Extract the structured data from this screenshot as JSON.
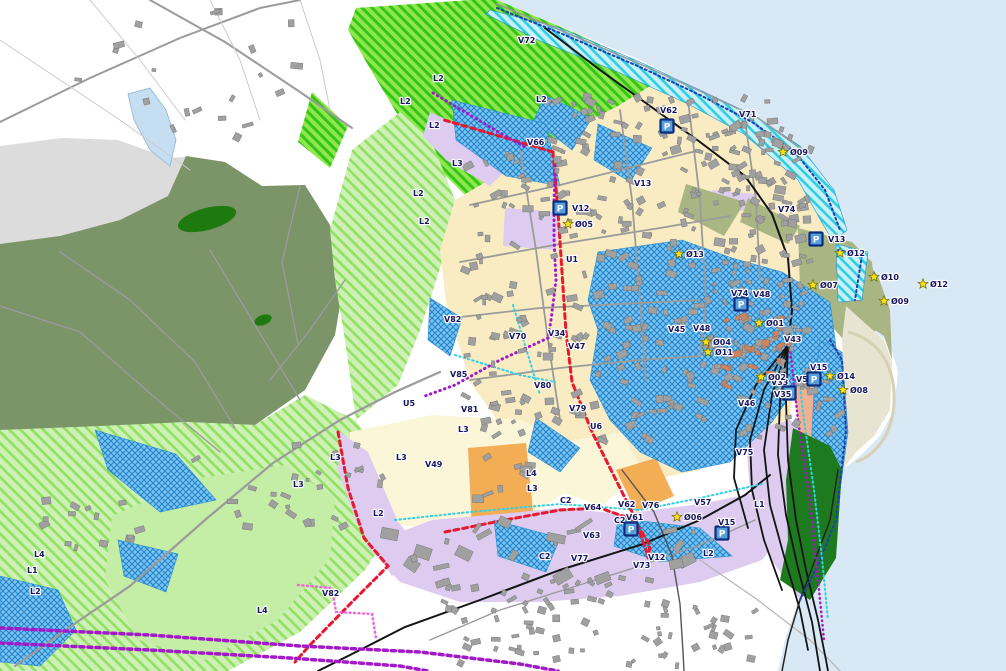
{
  "map": {
    "title": "municipal zoning map",
    "colors": {
      "sea": "#d9e8f5",
      "land": "#ffffff",
      "gray_zone": "#dcdcdc",
      "forest": "#7b9468",
      "forest_dark": "#1d7a0e",
      "lime_base": "#8fe750",
      "lime_stripe": "#35c517",
      "green_base": "#cdf0b4",
      "green_stripe": "#92e063",
      "green_plain": "#c4eda6",
      "beige": "#f9ecc3",
      "pale_yellow": "#fbf6d8",
      "orange": "#f2ad55",
      "lavender": "#ddccf0",
      "salmon": "#f0b193",
      "salmon_building": "#d4825c",
      "olive": "#a9b583",
      "pier_green": "#1d7a1f",
      "flood_base": "#7fc3ee",
      "flood_stripe": "#1f86cf",
      "cyan_base": "#c8f0f6",
      "cyan_stripe": "#2ecfe3",
      "building": "#a0a0a0",
      "road": "#9b9b9b",
      "rail": "#141414",
      "red_line": "#e8192e",
      "purple_line": "#a219c9",
      "pink_line": "#ee6ad8",
      "navy_line": "#1f3fb0",
      "cyan_line": "#35cfe2",
      "star_fill": "#ffe11a",
      "icon_fill": "#58a0dc",
      "icon_border": "#0b2d7d",
      "label_color": "#141460",
      "lake": "#c5def2",
      "sand": "#e8e4d2"
    },
    "labels": [
      {
        "t": "V72",
        "x": 518,
        "y": 43
      },
      {
        "t": "L2",
        "x": 433,
        "y": 81
      },
      {
        "t": "L2",
        "x": 536,
        "y": 102
      },
      {
        "t": "L2",
        "x": 400,
        "y": 104
      },
      {
        "t": "V71",
        "x": 739,
        "y": 117
      },
      {
        "t": "L2",
        "x": 429,
        "y": 128
      },
      {
        "t": "V66",
        "x": 527,
        "y": 145
      },
      {
        "t": "L3",
        "x": 452,
        "y": 166
      },
      {
        "t": "V13",
        "x": 634,
        "y": 186
      },
      {
        "t": "L2",
        "x": 413,
        "y": 196
      },
      {
        "t": "V74",
        "x": 778,
        "y": 212
      },
      {
        "t": "L2",
        "x": 419,
        "y": 224
      },
      {
        "t": "U1",
        "x": 566,
        "y": 262
      },
      {
        "t": "V48",
        "x": 753,
        "y": 297
      },
      {
        "t": "V82",
        "x": 444,
        "y": 322
      },
      {
        "t": "V48",
        "x": 693,
        "y": 331
      },
      {
        "t": "V45",
        "x": 668,
        "y": 332
      },
      {
        "t": "V34",
        "x": 548,
        "y": 336
      },
      {
        "t": "V70",
        "x": 509,
        "y": 339
      },
      {
        "t": "V43",
        "x": 784,
        "y": 342
      },
      {
        "t": "V47",
        "x": 568,
        "y": 349
      },
      {
        "t": "V85",
        "x": 450,
        "y": 377
      },
      {
        "t": "V33",
        "x": 771,
        "y": 385
      },
      {
        "t": "V51",
        "x": 796,
        "y": 382
      },
      {
        "t": "V80",
        "x": 534,
        "y": 388
      },
      {
        "t": "U5",
        "x": 403,
        "y": 406
      },
      {
        "t": "V46",
        "x": 738,
        "y": 406
      },
      {
        "t": "V79",
        "x": 569,
        "y": 411
      },
      {
        "t": "V81",
        "x": 461,
        "y": 412
      },
      {
        "t": "U6",
        "x": 590,
        "y": 429
      },
      {
        "t": "L3",
        "x": 458,
        "y": 432
      },
      {
        "t": "V75",
        "x": 736,
        "y": 455
      },
      {
        "t": "L3",
        "x": 396,
        "y": 460
      },
      {
        "t": "L3",
        "x": 330,
        "y": 460
      },
      {
        "t": "V49",
        "x": 425,
        "y": 467
      },
      {
        "t": "L4",
        "x": 526,
        "y": 476
      },
      {
        "t": "L3",
        "x": 293,
        "y": 487
      },
      {
        "t": "L3",
        "x": 527,
        "y": 491
      },
      {
        "t": "C2",
        "x": 560,
        "y": 503
      },
      {
        "t": "V57",
        "x": 694,
        "y": 505
      },
      {
        "t": "L1",
        "x": 754,
        "y": 507
      },
      {
        "t": "V62",
        "x": 618,
        "y": 507
      },
      {
        "t": "V76",
        "x": 642,
        "y": 508
      },
      {
        "t": "V64",
        "x": 584,
        "y": 510
      },
      {
        "t": "L2",
        "x": 373,
        "y": 516
      },
      {
        "t": "C2",
        "x": 614,
        "y": 523
      },
      {
        "t": "V63",
        "x": 583,
        "y": 538
      },
      {
        "t": "L4",
        "x": 34,
        "y": 557
      },
      {
        "t": "L2",
        "x": 703,
        "y": 556
      },
      {
        "t": "C2",
        "x": 539,
        "y": 559
      },
      {
        "t": "V12",
        "x": 648,
        "y": 560
      },
      {
        "t": "V77",
        "x": 571,
        "y": 561
      },
      {
        "t": "V73",
        "x": 633,
        "y": 568
      },
      {
        "t": "L1",
        "x": 27,
        "y": 573
      },
      {
        "t": "L2",
        "x": 30,
        "y": 594
      },
      {
        "t": "V82",
        "x": 322,
        "y": 596
      },
      {
        "t": "L4",
        "x": 257,
        "y": 613
      }
    ],
    "stars": [
      {
        "t": "Ø09",
        "x": 783,
        "y": 152
      },
      {
        "t": "Ø05",
        "x": 568,
        "y": 224
      },
      {
        "t": "Ø12",
        "x": 840,
        "y": 253
      },
      {
        "t": "Ø13",
        "x": 679,
        "y": 254
      },
      {
        "t": "Ø10",
        "x": 874,
        "y": 277
      },
      {
        "t": "Ø12",
        "x": 923,
        "y": 284
      },
      {
        "t": "Ø07",
        "x": 813,
        "y": 285
      },
      {
        "t": "Ø09",
        "x": 884,
        "y": 301
      },
      {
        "t": "Ø01",
        "x": 759,
        "y": 323
      },
      {
        "t": "Ø04",
        "x": 706,
        "y": 342
      },
      {
        "t": "Ø11",
        "x": 708,
        "y": 352
      },
      {
        "t": "Ø14",
        "x": 830,
        "y": 376
      },
      {
        "t": "Ø02",
        "x": 761,
        "y": 377
      },
      {
        "t": "Ø08",
        "x": 843,
        "y": 390
      },
      {
        "t": "Ø06",
        "x": 677,
        "y": 517
      }
    ],
    "plan_icons": [
      {
        "t": "V62",
        "x": 667,
        "y": 126,
        "lx": 660,
        "ly": 113
      },
      {
        "t": "V12",
        "x": 560,
        "y": 208,
        "lx": 572,
        "ly": 211
      },
      {
        "t": "V13",
        "x": 816,
        "y": 239,
        "lx": 828,
        "ly": 242
      },
      {
        "t": "V74",
        "x": 741,
        "y": 304,
        "lx": 731,
        "ly": 296
      },
      {
        "t": "V15",
        "x": 814,
        "y": 379,
        "lx": 810,
        "ly": 370
      },
      {
        "t": "V35",
        "x": 789,
        "y": 393,
        "lx": 774,
        "ly": 397
      },
      {
        "t": "V61",
        "x": 631,
        "y": 529,
        "lx": 626,
        "ly": 520
      },
      {
        "t": "V15",
        "x": 722,
        "y": 533,
        "lx": 718,
        "ly": 525
      }
    ]
  }
}
